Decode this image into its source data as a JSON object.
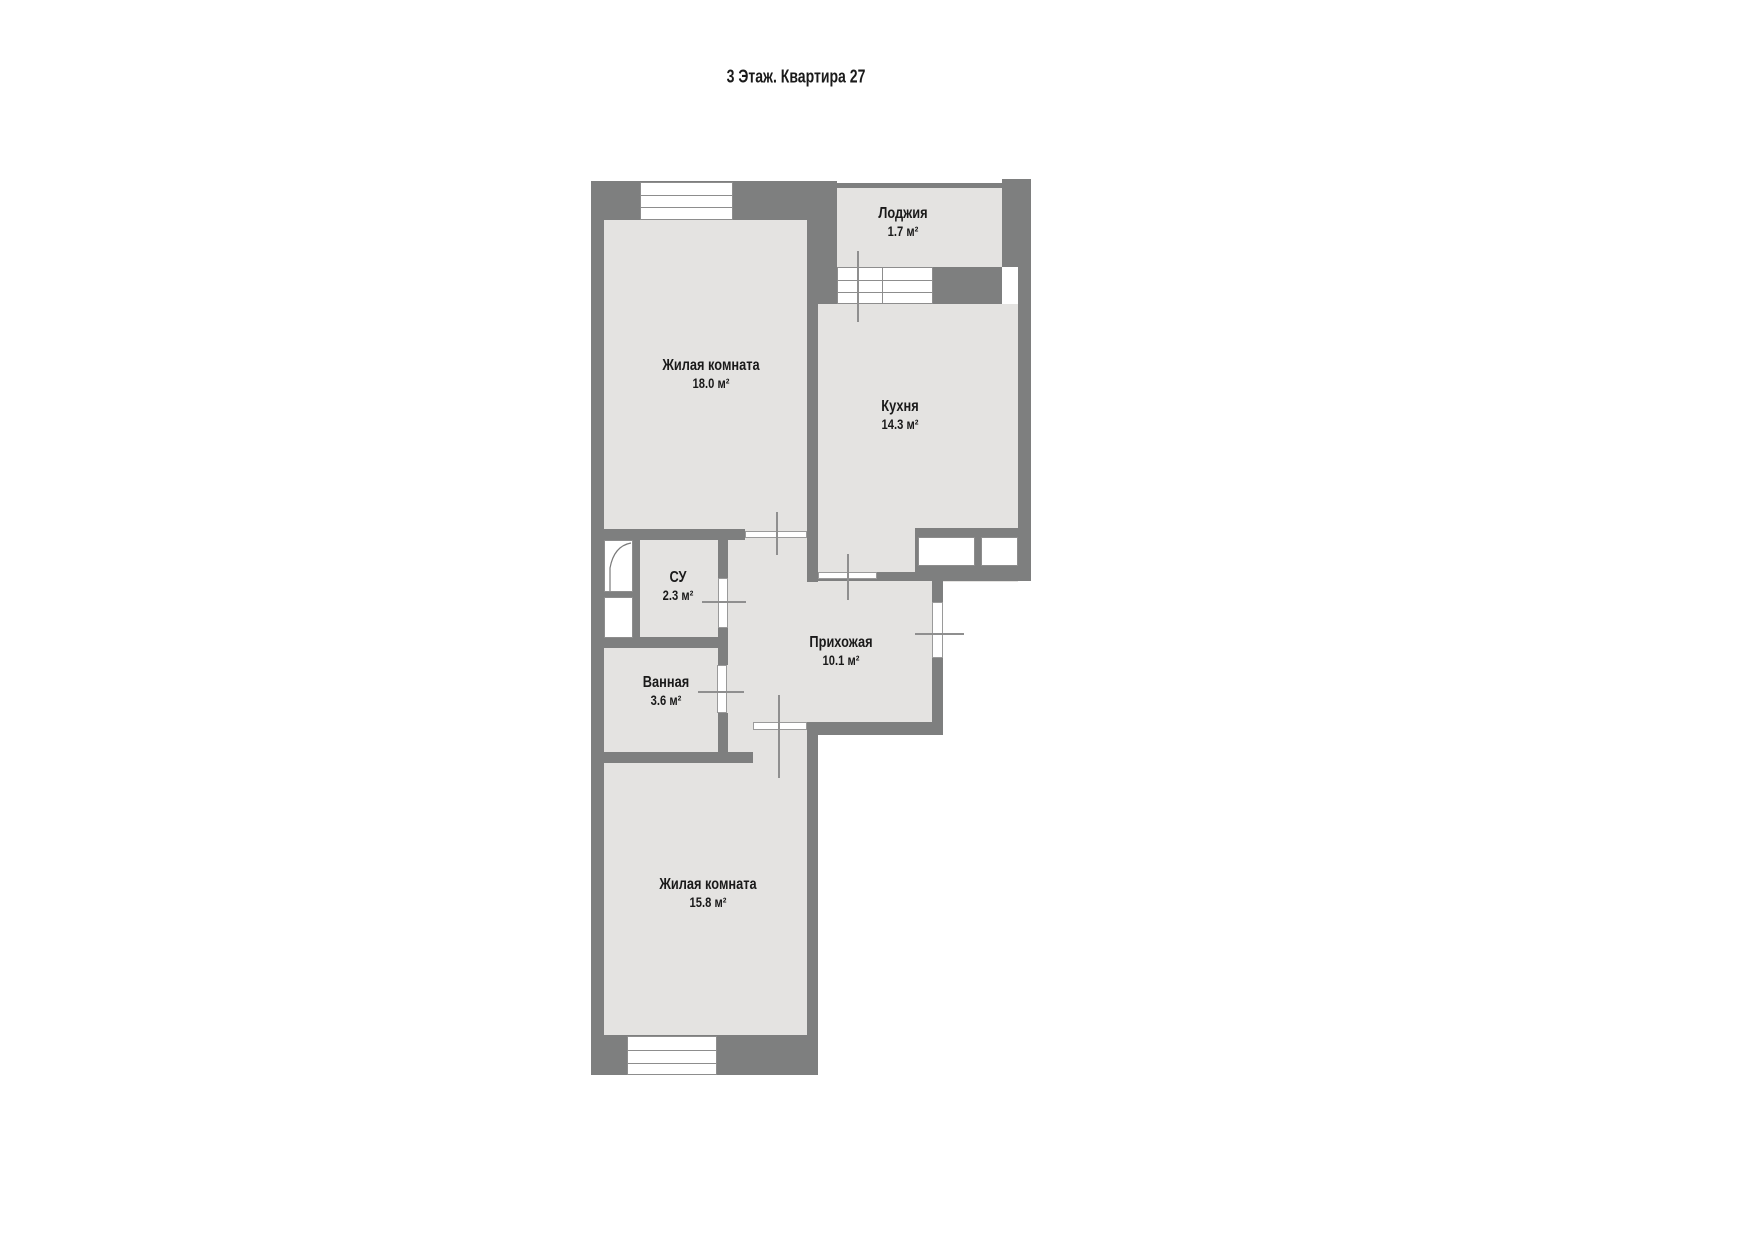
{
  "title": "3 Этаж. Квартира 27",
  "colors": {
    "wall": "#7e7f7f",
    "floor": "#e4e3e1",
    "door_line": "#8f8f8f",
    "text": "#1a1a1a"
  },
  "rooms": [
    {
      "id": "loggia",
      "name": "Лоджия",
      "area": "1.7 м²"
    },
    {
      "id": "living1",
      "name": "Жилая комната",
      "area": "18.0 м²"
    },
    {
      "id": "kitchen",
      "name": "Кухня",
      "area": "14.3 м²"
    },
    {
      "id": "wc",
      "name": "СУ",
      "area": "2.3 м²"
    },
    {
      "id": "hall",
      "name": "Прихожая",
      "area": "10.1 м²"
    },
    {
      "id": "bath",
      "name": "Ванная",
      "area": "3.6 м²"
    },
    {
      "id": "living2",
      "name": "Жилая комната",
      "area": "15.8 м²"
    }
  ]
}
